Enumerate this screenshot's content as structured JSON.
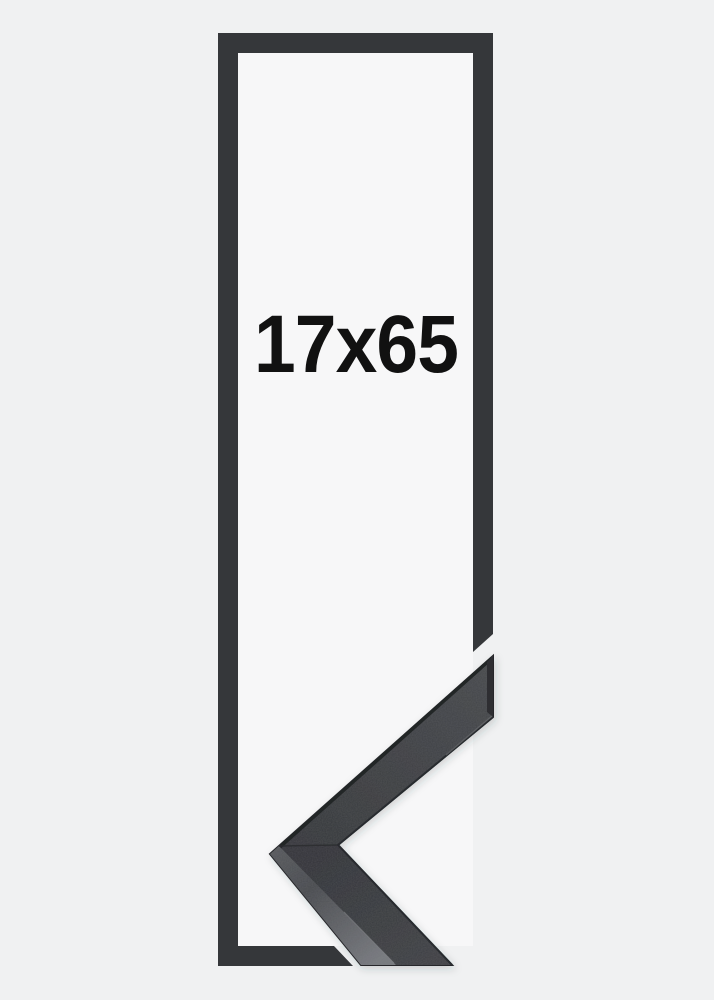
{
  "product": {
    "size_label": "17x65"
  },
  "colors": {
    "background": "#f0f1f2",
    "frame_opening": "#f7f7f8",
    "frame_outline": "#35373a",
    "label_text": "#111111",
    "moulding_face": "#3b3d40",
    "moulding_edge_dark": "#26282b",
    "moulding_side_light": "#75777c"
  }
}
